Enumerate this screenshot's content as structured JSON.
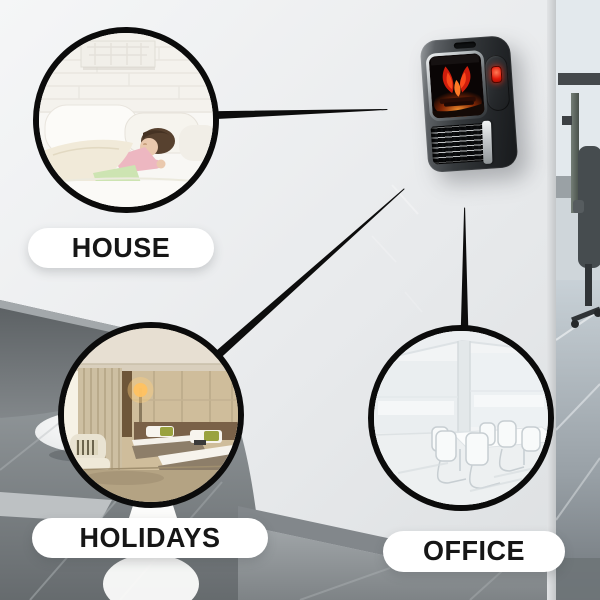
{
  "meta": {
    "kind": "product-callout-collage",
    "canvas_size": "600x600"
  },
  "callouts": [
    {
      "id": "house",
      "label": "HOUSE"
    },
    {
      "id": "holidays",
      "label": "HOLIDAYS"
    },
    {
      "id": "office",
      "label": "OFFICE"
    }
  ],
  "product": {
    "semantic": "wall-mounted-flame-effect-mini-heater",
    "parts": [
      "hanger-notch",
      "flame-display",
      "power-button",
      "air-outlet-grille",
      "chrome-trim"
    ]
  },
  "scenes": {
    "house_photo": "child-sleeping-in-white-bed",
    "holidays_photo": "hotel-twin-bed-room",
    "office_photo": "bright-meeting-room-white-chairs",
    "background": "office-wall-with-side-room"
  },
  "colors": {
    "wall": "#e9ebed",
    "connector_line": "#0d0d0d",
    "circle_border": "#0b0b0b",
    "pill_bg": "#ffffff",
    "pill_text": "#161616",
    "flame_red": "#cf1d0c",
    "flame_orange": "#ff7a26",
    "button_red": "#e2190a",
    "heater_body": "#232629",
    "heater_chrome": "#c3c7ca"
  }
}
